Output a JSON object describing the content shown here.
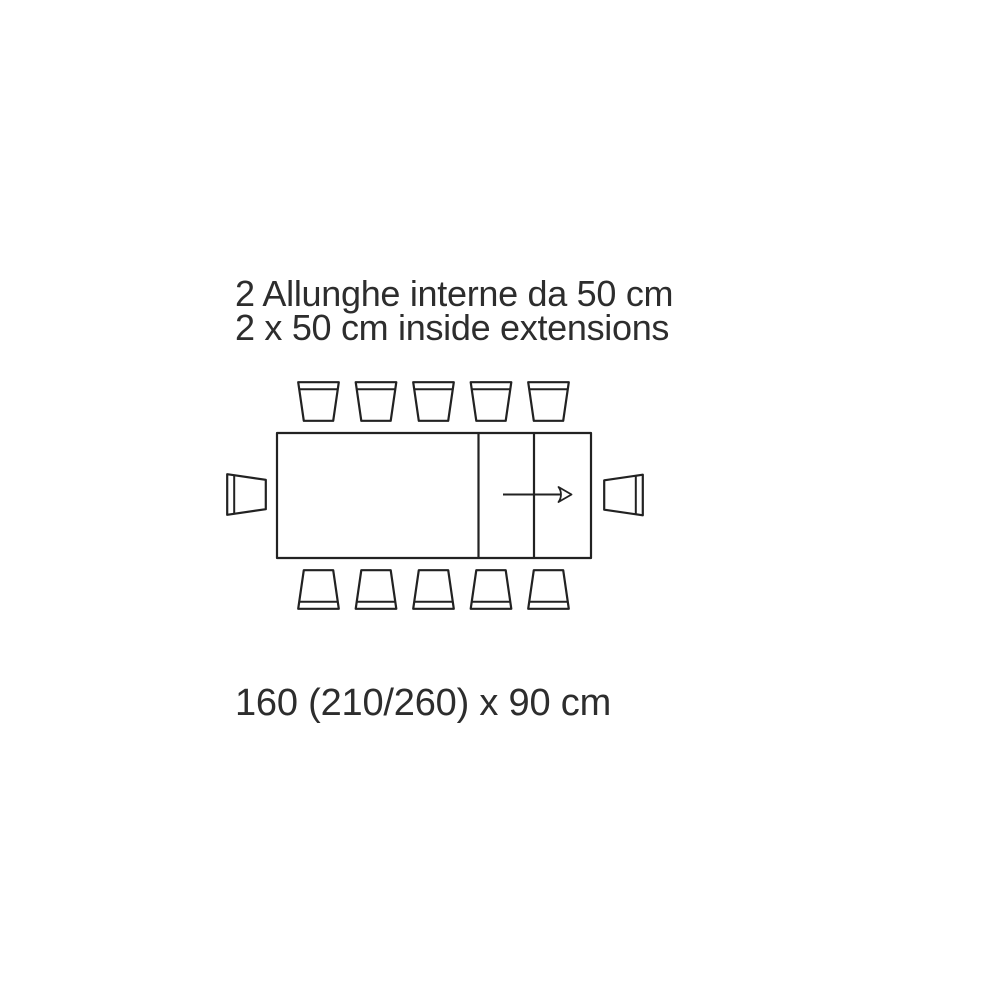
{
  "title": {
    "line1": "2 Allunghe interne da 50 cm",
    "line2": "2 x 50 cm inside extensions"
  },
  "dimension_label": "160 (210/260) x 90 cm",
  "diagram": {
    "type": "furniture-plan-top-view",
    "subject": "extendable-dining-table-with-chairs",
    "table": {
      "closed_length_cm": 160,
      "extended_lengths_cm": [
        210,
        260
      ],
      "depth_cm": 90,
      "extensions": {
        "count": 2,
        "size_cm": 50,
        "placement": "inside"
      },
      "extension_direction": "right",
      "divider_count": 2
    },
    "seats": {
      "top": 5,
      "bottom": 5,
      "left": 1,
      "right": 1,
      "total": 12
    }
  },
  "colors": {
    "line": "#222222",
    "text": "#2d2d2d",
    "background": "#ffffff"
  }
}
